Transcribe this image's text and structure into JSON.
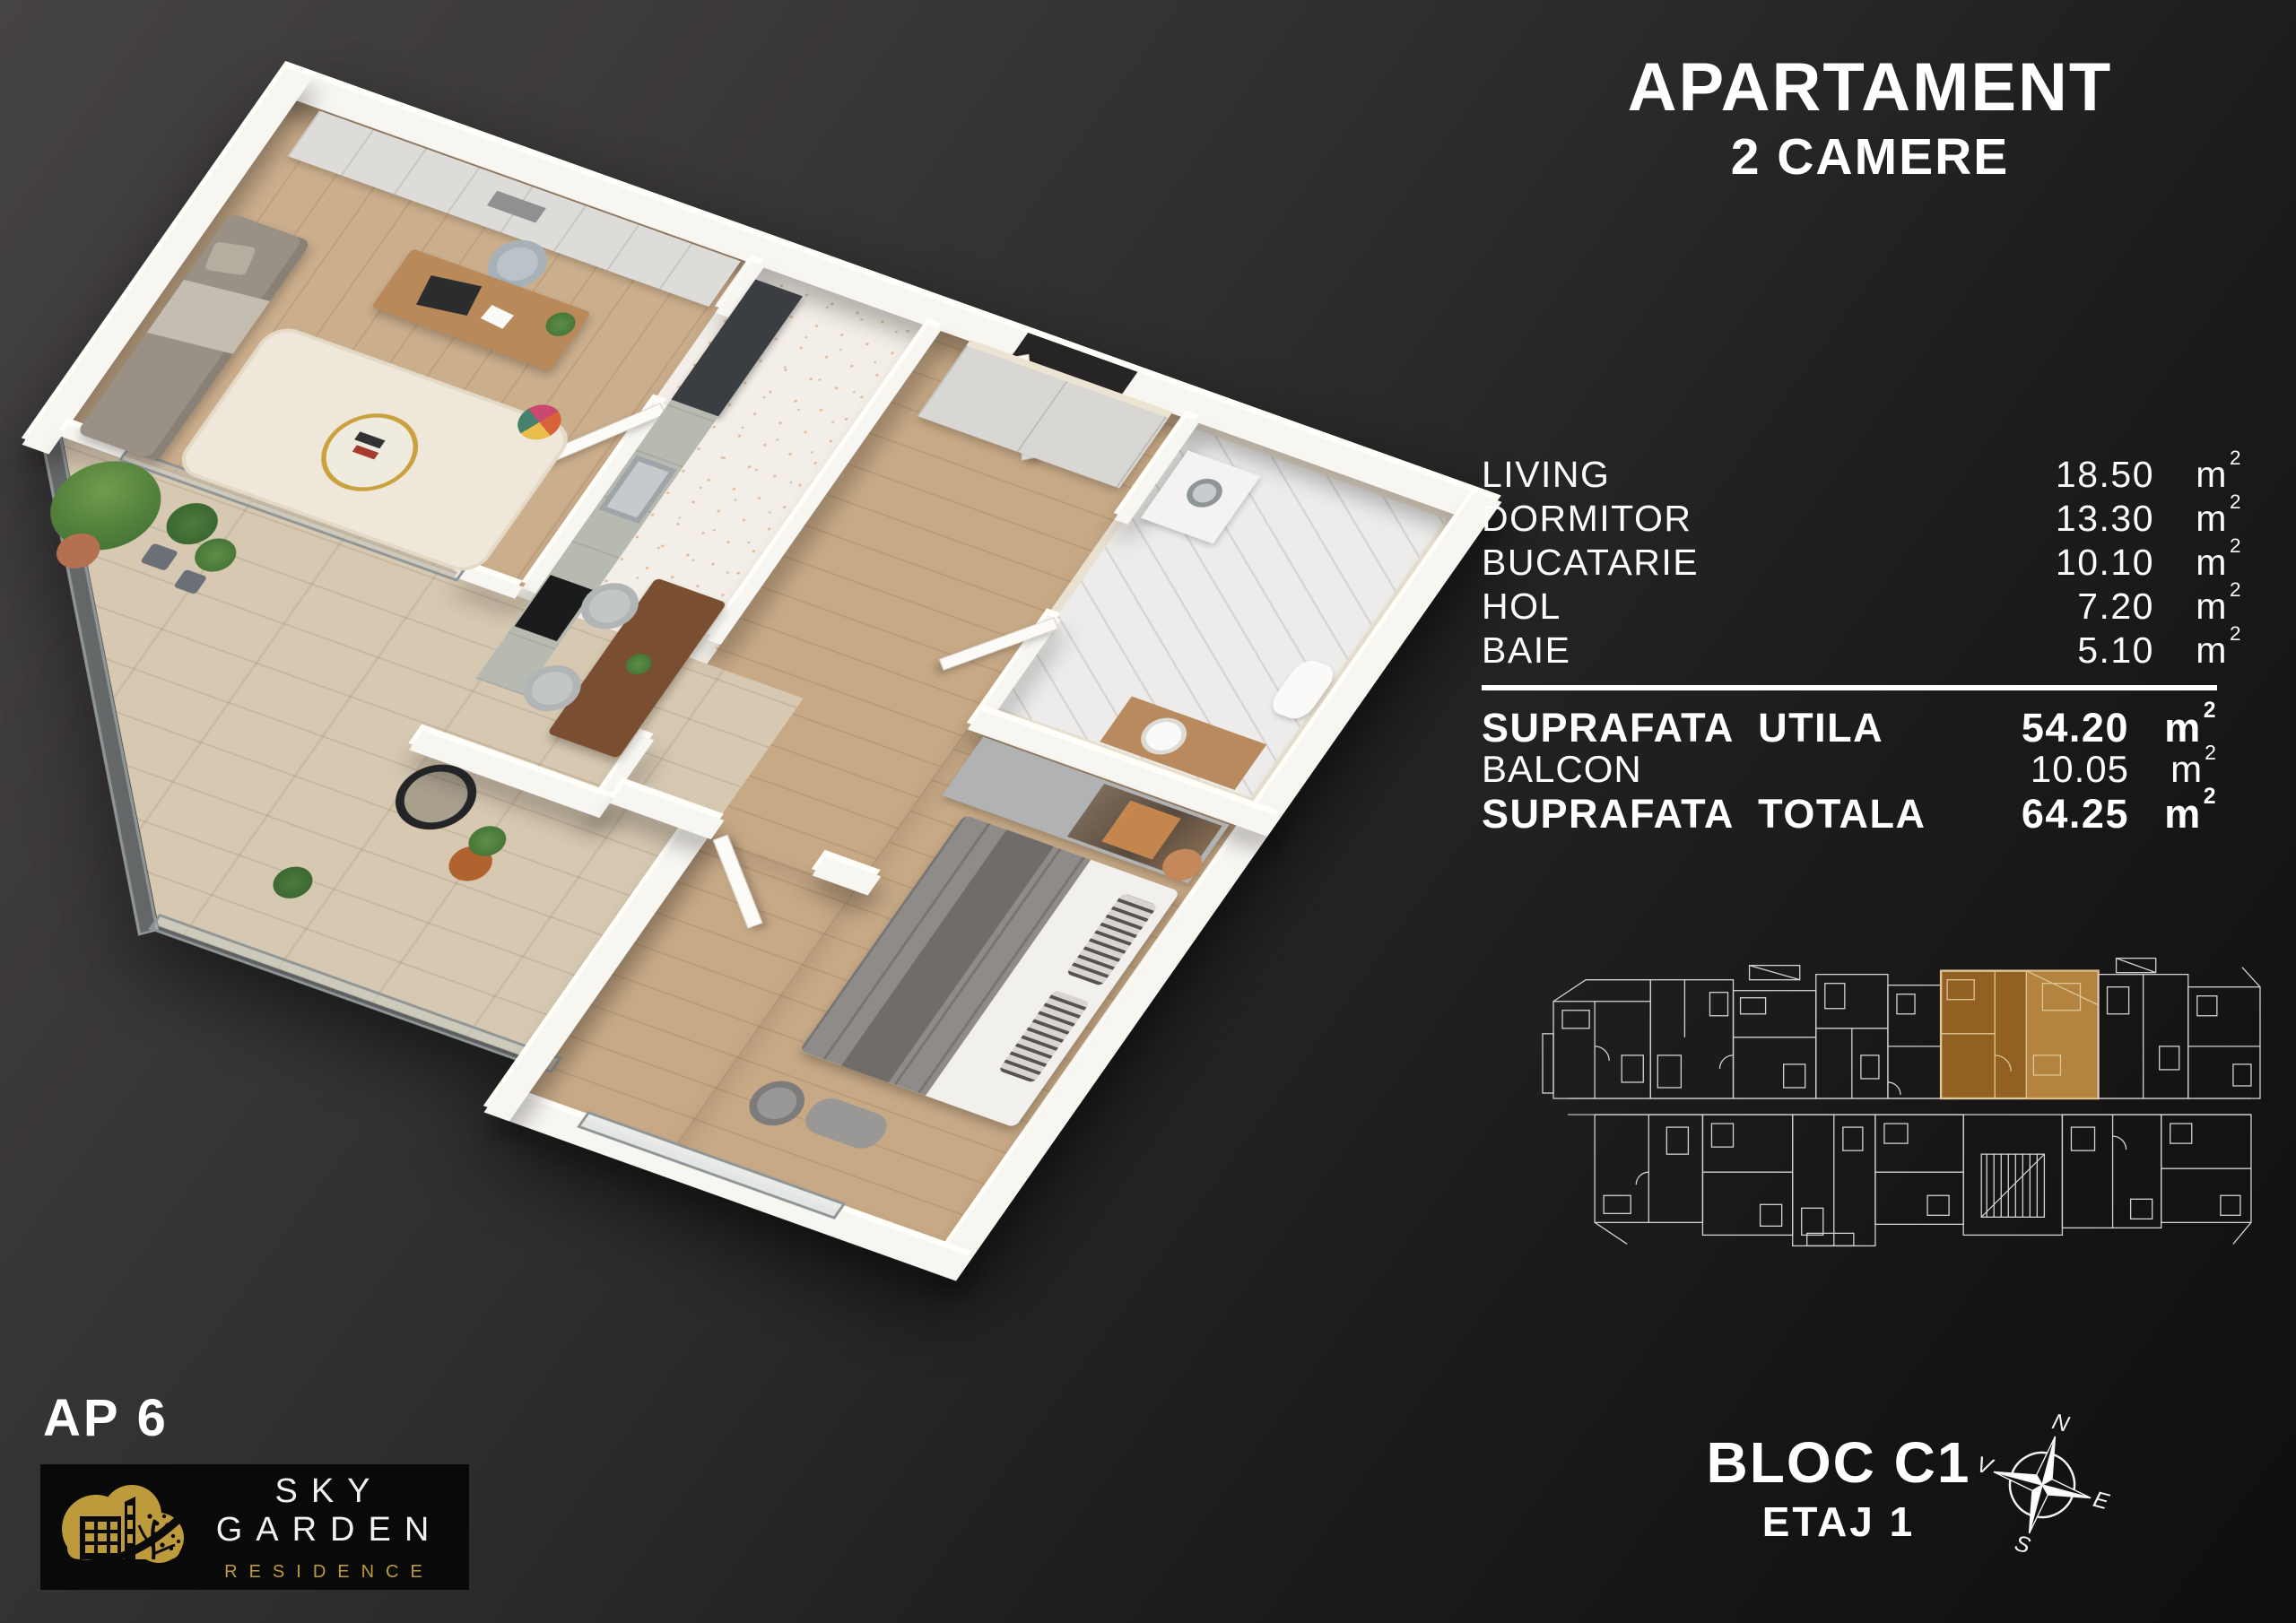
{
  "header": {
    "title": "APARTAMENT",
    "subtitle": "2 CAMERE"
  },
  "areas": {
    "unit": "m",
    "unit_sup": "2",
    "rooms": [
      {
        "label": "LIVING",
        "value": "18.50"
      },
      {
        "label": "DORMITOR",
        "value": "13.30"
      },
      {
        "label": "BUCATARIE",
        "value": "10.10"
      },
      {
        "label": "HOL",
        "value": "7.20"
      },
      {
        "label": "BAIE",
        "value": "5.10"
      }
    ],
    "summary": [
      {
        "label": "SUPRAFATA  UTILA",
        "value": "54.20"
      },
      {
        "label": "BALCON",
        "value": "10.05"
      },
      {
        "label": "SUPRAFATA  TOTALA",
        "value": "64.25"
      }
    ]
  },
  "footer": {
    "apartment": "AP 6",
    "block_line1": "BLOC C1",
    "block_line2": "ETAJ 1"
  },
  "logo": {
    "title": "SKY GARDEN",
    "subtitle": "RESIDENCE"
  },
  "compass": {
    "north": "N",
    "east": "E",
    "south": "S",
    "west": "V"
  },
  "colors": {
    "background_top": "#464344",
    "background_bottom": "#100e0f",
    "accent_gold": "#bd9b3c",
    "highlight_orange": "#9d6822",
    "highlight_light": "#e7bd7f",
    "blueprint_line": "#e3e2df",
    "wall_white": "#f8f6f1",
    "wood_floor": "#cbae8c",
    "terrazzo_floor": "#f3efe8",
    "travertine_floor": "#d6c8b1",
    "marble_floor": "#edecea"
  }
}
